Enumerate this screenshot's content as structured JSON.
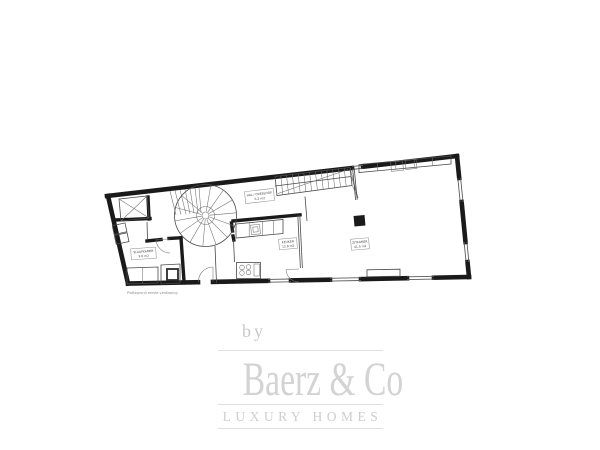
{
  "page": {
    "background": "#ffffff"
  },
  "floor_plan": {
    "caption": "Plattegrond eerste verdieping",
    "colors": {
      "wall": "#1a1a1a",
      "thin_line": "#4a4a4a",
      "label_border": "#8f8f8f"
    },
    "room_labels": [
      {
        "id": "hall",
        "line1": "HAL / OVERLOOP",
        "line2": "6.2 m2"
      },
      {
        "id": "bedroom",
        "line1": "SLAAPKAMER",
        "line2": "9.6 m2"
      },
      {
        "id": "kitchen",
        "line1": "KEUKEN",
        "line2": "12.8 m2"
      },
      {
        "id": "living",
        "line1": "ZITKAMER",
        "line2": "41.5 m2"
      }
    ]
  },
  "watermark": {
    "by": "by",
    "brand": "Baerz & Co",
    "tagline": "LUXURY HOMES",
    "text_color": "#d3d3d3",
    "rule_color": "#dfdfdf"
  }
}
